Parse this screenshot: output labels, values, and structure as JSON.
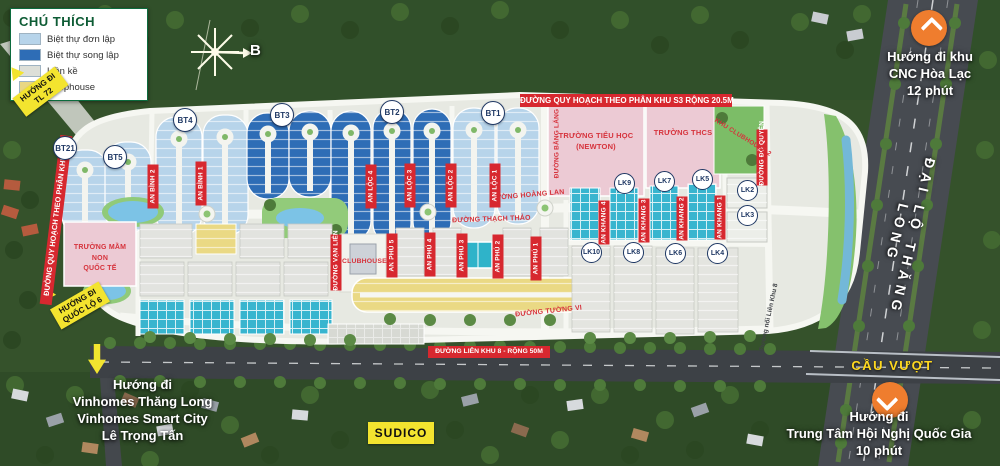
{
  "legend": {
    "title": "CHÚ THÍCH",
    "items": [
      {
        "label": "Biệt thự đơn lập",
        "color": "#b7d4ea"
      },
      {
        "label": "Biệt thự song lập",
        "color": "#2e6db6"
      },
      {
        "label": "Liền kề",
        "color": "#dddfd8"
      },
      {
        "label": "Shophouse",
        "color": "#e9d783"
      }
    ]
  },
  "compass": {
    "north_label": "B"
  },
  "badges": {
    "tl72": {
      "line1": "HƯỚNG ĐI",
      "line2": "TL 72"
    },
    "ql6": {
      "line1": "HƯỚNG ĐI",
      "line2": "QUỐC LỘ 6"
    },
    "sudico": "SUDICO"
  },
  "directions": {
    "cnc": {
      "line1": "Hướng đi khu",
      "line2": "CNC Hòa Lạc",
      "line3": "12 phút"
    },
    "hoinghi": {
      "line1": "Hướng đi",
      "line2": "Trung Tâm Hội Nghị Quốc Gia",
      "line3": "10 phút"
    },
    "vinhomes": {
      "line1": "Hướng đi",
      "line2": "Vinhomes Thăng Long",
      "line3": "Vinhomes Smart City",
      "line4": "Lê Trọng Tấn"
    }
  },
  "roads": {
    "avenue": "ĐẠI LỘ THĂNG LONG",
    "overpass": "CẦU VƯỢT",
    "top_banner": "ĐƯỜNG QUY HOẠCH THEO PHÂN KHU S3 RỘNG 20.5M",
    "left_banner": "ĐƯỜNG QUY HOẠCH THEO PHÂN KHU S3",
    "bottom_banner": "ĐƯỜNG LIÊN KHU 8 - RỘNG 50M",
    "hoang_lan": "ĐƯỜNG HOÀNG LAN",
    "thach_thao": "ĐƯỜNG THẠCH THẢO",
    "tuong_vi": "ĐƯỜNG TƯỜNG VI",
    "bang_lang": "ĐƯỜNG BẰNG LĂNG",
    "do_quyen": "ĐƯỜNG ĐỖ QUYÊN",
    "van_lien": "ĐƯỜNG VẠN LIÊN",
    "noi_lien_khu": "Đường nối Liên Khu 8"
  },
  "streets": {
    "an_binh": [
      "AN BÌNH 2",
      "AN BÌNH 1"
    ],
    "an_loc": [
      "AN LỘC 4",
      "AN LỘC 3",
      "AN LỘC 2",
      "AN LỘC 1"
    ],
    "an_phu": [
      "AN PHÚ 5",
      "AN PHÚ 4",
      "AN PHÚ 3",
      "AN PHÚ 2",
      "AN PHÚ 1"
    ],
    "an_khang": [
      "AN KHANG 4",
      "AN KHANG 3",
      "AN KHANG 2",
      "AN KHANG 1"
    ]
  },
  "facilities": {
    "tieu_hoc": {
      "line1": "TRƯỜNG TIỂU HỌC",
      "line2": "(NEWTON)"
    },
    "thcs": "TRƯỜNG THCS",
    "mam_non": {
      "line1": "TRƯỜNG MẦM NON",
      "line2": "QUỐC TẾ"
    },
    "clubhouse1": "CLUBHOUSE 1",
    "clubhouse2": "KHU CLUBHOUSE 2"
  },
  "blocks": {
    "bt": [
      "BT21",
      "BT5",
      "BT4",
      "BT3",
      "BT2",
      "BT1"
    ],
    "lk_top": [
      "LK9",
      "LK7",
      "LK5"
    ],
    "lk_right": [
      "LK2",
      "LK3"
    ],
    "lk_bottom": [
      "LK10",
      "LK8",
      "LK6",
      "LK4"
    ]
  },
  "colors": {
    "accent_red": "#d7282f",
    "accent_yellow": "#f3e42f",
    "accent_orange": "#ef7d2e",
    "overpass_text": "#ffd91f",
    "villa_single": "#b7d4ea",
    "villa_double": "#2e6db6",
    "lienke_teal": "#38b5cf",
    "shophouse_yellow": "#ead984",
    "school_pink": "#eccad4"
  }
}
